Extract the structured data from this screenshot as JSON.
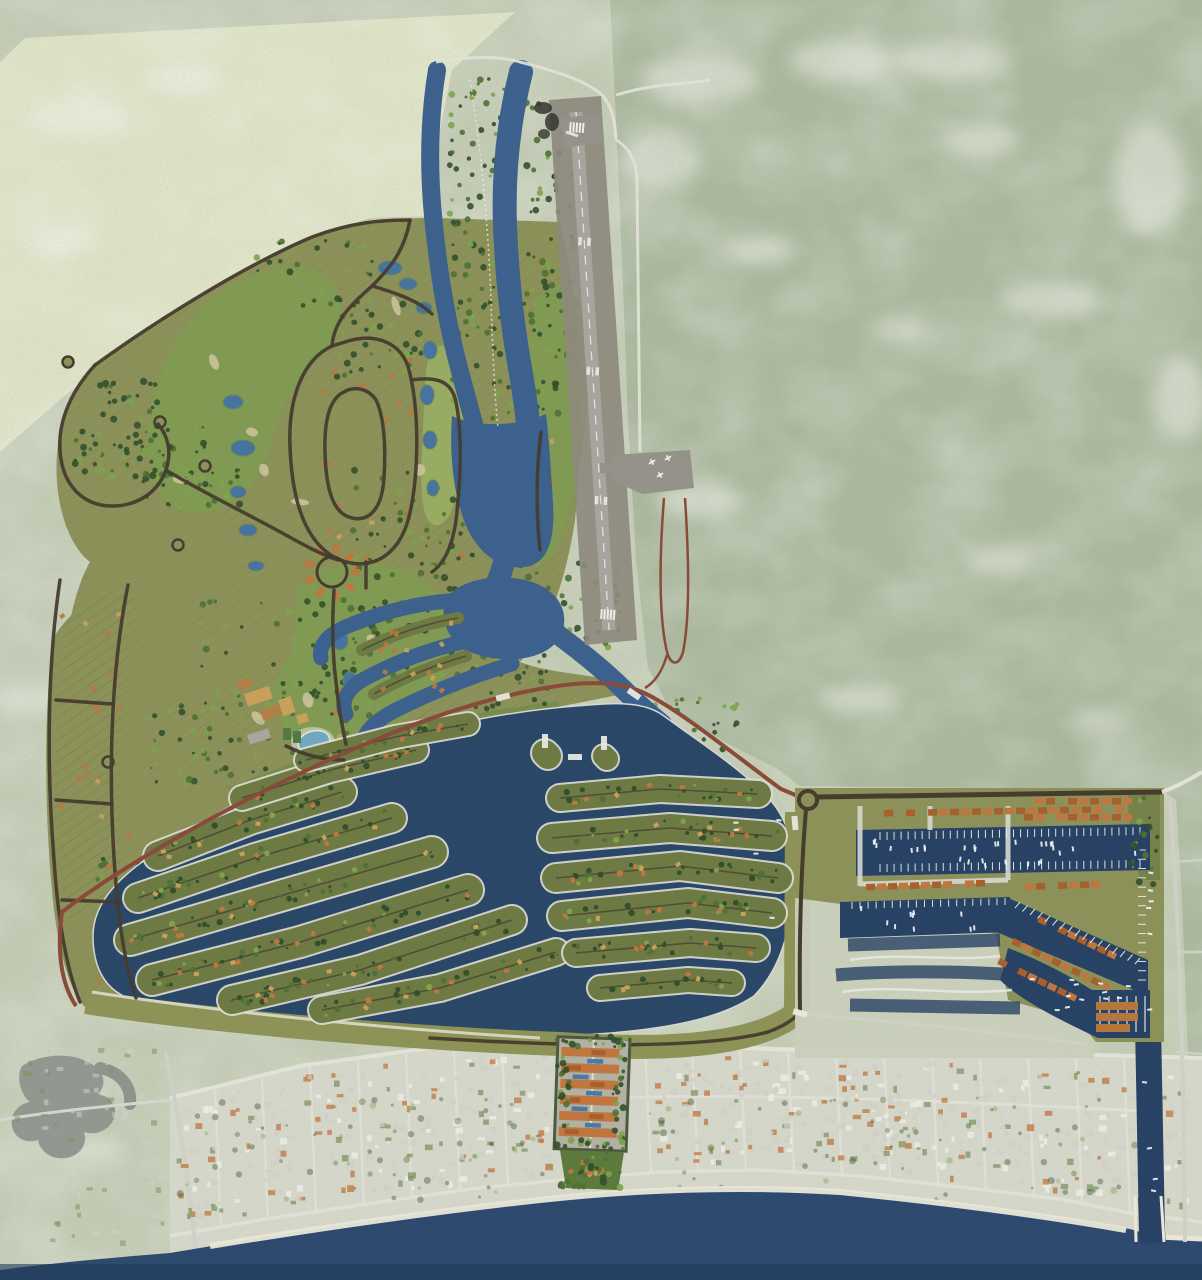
{
  "palette": {
    "bg": "#c3cbb5",
    "wedge": "#dde1c5",
    "forest": "#a9b69b",
    "white_patch": "#eceee6",
    "site_olive": "#8b9159",
    "fairway": "#7f9b52",
    "fairway_light": "#9ab364",
    "golf_band": "#6f8c48",
    "woods": "#33502c",
    "tree_mid": "#4f7134",
    "tree_light": "#7ba44b",
    "canal": "#3d618d",
    "district_water": "#2b4768",
    "marina_water": "#274264",
    "sea": "#2d4a6e",
    "sea_deep": "#203a59",
    "pond": "#4673a0",
    "pool": "#6fa7c2",
    "road_dark": "#463c2e",
    "road_red": "#8a4a39",
    "road_pale": "#cfd0c6",
    "road_white": "#e2e2d8",
    "runway": "#a6a59d",
    "apron": "#95928a",
    "corridor": "#8d8a7d",
    "seawall": "#dcdcd2",
    "island": "#6d7a44",
    "berm": "#8d9257",
    "roof_orange": "#c0763f",
    "roof_tan": "#c8a05a",
    "shed": "#b5763b",
    "sand": "#eae7d9",
    "town": "#d4d6c9",
    "building_gray": "#cfcfc6",
    "building_green": "#7d9460",
    "building_white": "#efefe8",
    "lagoon": "#8f938e",
    "future": "#c9cfbb",
    "dock": "#f2f2ec",
    "boat": "#ffffff",
    "smoke": "#35352f",
    "condo_base": "#b3b1a4",
    "garden": "#5d7a3d"
  },
  "features": [
    {
      "name": "surrounding-terrain",
      "color_key": "forest"
    },
    {
      "name": "cleared-land-northwest",
      "color_key": "wedge"
    },
    {
      "name": "golf-course-fairways",
      "color_key": "fairway"
    },
    {
      "name": "residential-parcel-bands",
      "color_key": "site_olive"
    },
    {
      "name": "oval-loop-road",
      "color_key": "road_dark"
    },
    {
      "name": "villa-cluster",
      "color_key": "roof_orange"
    },
    {
      "name": "clubhouse-amenity-pool",
      "color_key": "pool"
    },
    {
      "name": "north-canal",
      "color_key": "canal"
    },
    {
      "name": "golf-ponds",
      "color_key": "pond"
    },
    {
      "name": "airstrip-runway",
      "color_key": "runway"
    },
    {
      "name": "runway-apron",
      "color_key": "apron"
    },
    {
      "name": "main-boundary-road",
      "color_key": "road_red"
    },
    {
      "name": "canal-residential-district",
      "color_key": "district_water"
    },
    {
      "name": "finger-islands",
      "color_key": "island"
    },
    {
      "name": "southern-berm",
      "color_key": "berm"
    },
    {
      "name": "marina-village",
      "color_key": "site_olive"
    },
    {
      "name": "marina-basins",
      "color_key": "marina_water"
    },
    {
      "name": "townhouse-rows",
      "color_key": "roof_orange"
    },
    {
      "name": "boat-docks",
      "color_key": "dock"
    },
    {
      "name": "ocean-inlet-channel",
      "color_key": "marina_water"
    },
    {
      "name": "future-phase-parcels",
      "color_key": "future"
    },
    {
      "name": "beach-condo-site",
      "color_key": "condo_base"
    },
    {
      "name": "coastal-town",
      "color_key": "town"
    },
    {
      "name": "beach-shoreline",
      "color_key": "sand"
    },
    {
      "name": "sea",
      "color_key": "sea"
    },
    {
      "name": "west-lagoon",
      "color_key": "lagoon"
    }
  ],
  "stats": {
    "finger_islands": 16,
    "golf_ponds": 14,
    "marina_basins": 3,
    "runways": 1
  }
}
